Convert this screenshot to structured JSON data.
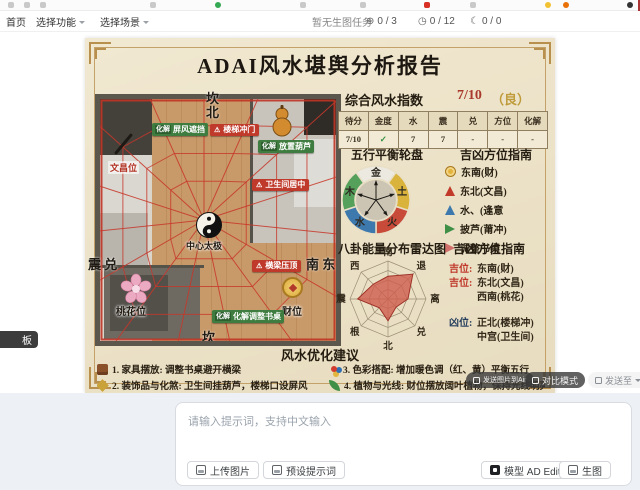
{
  "toolbar": {
    "home": "首页",
    "select_function": "选择功能",
    "select_scene": "选择场景",
    "task_status": "暂无生图任务",
    "counters": [
      {
        "icon": "circle-up",
        "value": "0 / 3"
      },
      {
        "icon": "clock",
        "value": "0 / 12"
      },
      {
        "icon": "moon",
        "value": "0 / 0"
      }
    ]
  },
  "report": {
    "title": "ADAI风水堪舆分析报告",
    "score": {
      "label": "综合风水指数",
      "value": "7/10",
      "grade": "（良）"
    },
    "table": {
      "headers": [
        "待分",
        "金度",
        "水",
        "震",
        "兑",
        "方位",
        "化解"
      ],
      "row": [
        "7/10",
        "✓",
        "7",
        "7",
        "-",
        "-",
        "-"
      ]
    },
    "wheel_title": "五行平衡轮盘",
    "legend_title": "吉凶方位指南",
    "legend": [
      {
        "icon": "coin",
        "text": "东南(财)"
      },
      {
        "icon": "tri-red",
        "text": "东北(文昌)"
      },
      {
        "icon": "tri-blue",
        "text": "水、(逢意"
      },
      {
        "icon": "arr-green",
        "text": "披芦(莆冲)"
      },
      {
        "icon": "arr-pink",
        "text": "调整书桌"
      }
    ],
    "radar_title": "八卦能量分布雷达图",
    "guide_title": "吉凶方位指南",
    "directions": [
      {
        "tag": "吉位:",
        "type": "ji",
        "text": "东南(财)"
      },
      {
        "tag": "吉位:",
        "type": "ji",
        "text": "东北(文昌)"
      },
      {
        "tag": "",
        "type": "ji",
        "text": "西南(桃花)"
      },
      {
        "tag": "凶位:",
        "type": "xiong",
        "text": "正北(楼梯冲)",
        "gap": true
      },
      {
        "tag": "",
        "type": "xiong",
        "text": "中宫(卫生间)"
      }
    ],
    "suggestions_title": "风水优化建议",
    "suggestions": [
      {
        "icon": "furniture",
        "text": "1. 家具摆放: 调整书桌避开横梁"
      },
      {
        "icon": "palette",
        "text": "3. 色彩搭配: 增加暖色调（红、黄）平衡五行"
      },
      {
        "icon": "brush",
        "text": "2. 装饰品与化煞: 卫生间挂葫芦，楼梯口设屏风"
      },
      {
        "icon": "plant",
        "text": "4. 植物与光线: 财位摆放阔叶植物，保持光线明亮"
      }
    ],
    "plan": {
      "mitigate_tag": "化解",
      "compass": {
        "top_upper": "坎",
        "top_lower": "北",
        "bottom": "坎",
        "left": "震 兑",
        "right": "南 东"
      },
      "badges": {
        "screen": "屏风遮挡",
        "stairs": "楼梯冲门",
        "gourd": "放置葫芦",
        "wenchang": "文昌位",
        "bathroom": "卫生间居中",
        "beam": "横梁压顶",
        "peach": "桃花位",
        "wealth": "财位",
        "desk": "化解调整书桌",
        "taiji": "中心太极"
      }
    }
  },
  "overlay": {
    "send_air": "发送图片到Air",
    "compare": "对比模式",
    "send_to": "发送至"
  },
  "left_badge": "板",
  "prompt": {
    "placeholder": "请输入提示词，支持中文输入"
  },
  "actions": {
    "upload": "上传图片",
    "preset": "预设提示词",
    "model": "模型 AD Edit",
    "generate": "生图"
  },
  "chart_data": [
    {
      "type": "radar",
      "title": "八卦能量分布雷达图",
      "categories": [
        "南",
        "退",
        "离",
        "兑",
        "北",
        "根",
        "震",
        "西"
      ],
      "values": [
        2.4,
        3.7,
        2.1,
        1.2,
        2.3,
        1.3,
        3.2,
        2.2
      ],
      "range": [
        0,
        4
      ],
      "rings": 4,
      "fill": "#d05c4e",
      "stroke": "#9e3328",
      "legend_position": "none",
      "grid": true
    },
    {
      "type": "pie",
      "title": "五行平衡轮盘",
      "labels": [
        "金",
        "土",
        "火",
        "水",
        "木"
      ],
      "values": [
        20,
        20,
        20,
        20,
        20
      ],
      "colors": [
        "#ebe9e0",
        "#d9b33c",
        "#c84a38",
        "#3e79ae",
        "#55a05a"
      ],
      "donut": true
    }
  ]
}
